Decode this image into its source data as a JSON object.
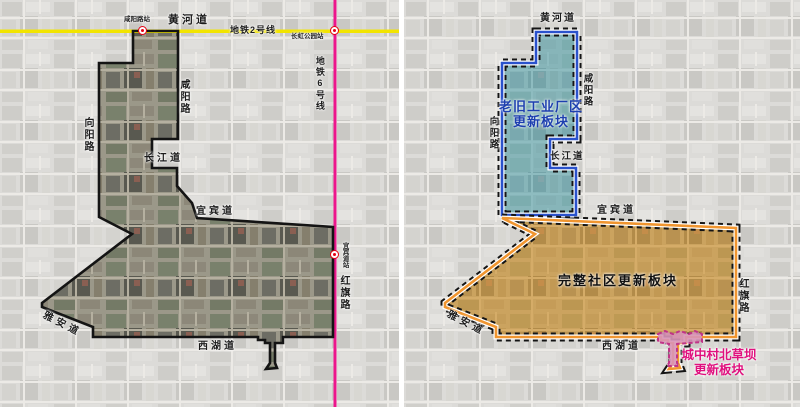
{
  "page": {
    "kind": "urban-renewal-planning-map-comparison",
    "width": 800,
    "height": 407
  },
  "colors": {
    "metro_line2": "#f2e400",
    "metro_line6": "#ec168c",
    "boundary": "#141414",
    "zone_industrial_fill": "#7fc0cc",
    "zone_industrial_border": "#2a52cc",
    "zone_industrial_text": "#1d3faf",
    "zone_community_fill": "#e8aa46",
    "zone_community_border": "#f0952f",
    "zone_community_text": "#111111",
    "zone_village_fill": "#d893b8",
    "zone_village_border": "#c03488",
    "zone_village_text": "#e0107e"
  },
  "transit": {
    "line2_label": "地铁2号线",
    "line6_label": "地铁6号线",
    "station_xianyang": "咸阳路站",
    "station_changhong": "长虹公园站",
    "station_yibindao": "宜宾道站"
  },
  "left_map": {
    "roads": {
      "huanghe": "黄河道",
      "xianyang": "咸阳路",
      "xiangyang": "向阳路",
      "changjiang": "长江道",
      "yibin": "宜宾道",
      "yaan": "雅安道",
      "xihu": "西湖道",
      "hongqi": "红旗路"
    }
  },
  "right_map": {
    "roads": {
      "huanghe": "黄河道",
      "xianyang": "咸阳路",
      "xiangyang": "向阳路",
      "changjiang": "长江道",
      "yibin": "宜宾道",
      "yaan": "雅安道",
      "xihu": "西湖道",
      "hongqi": "红旗路"
    },
    "zones": {
      "industrial": {
        "line1": "老旧工业厂区",
        "line2": "更新板块"
      },
      "community": {
        "label": "完整社区更新板块"
      },
      "village": {
        "line1": "城中村北草坝",
        "line2": "更新板块"
      }
    }
  }
}
